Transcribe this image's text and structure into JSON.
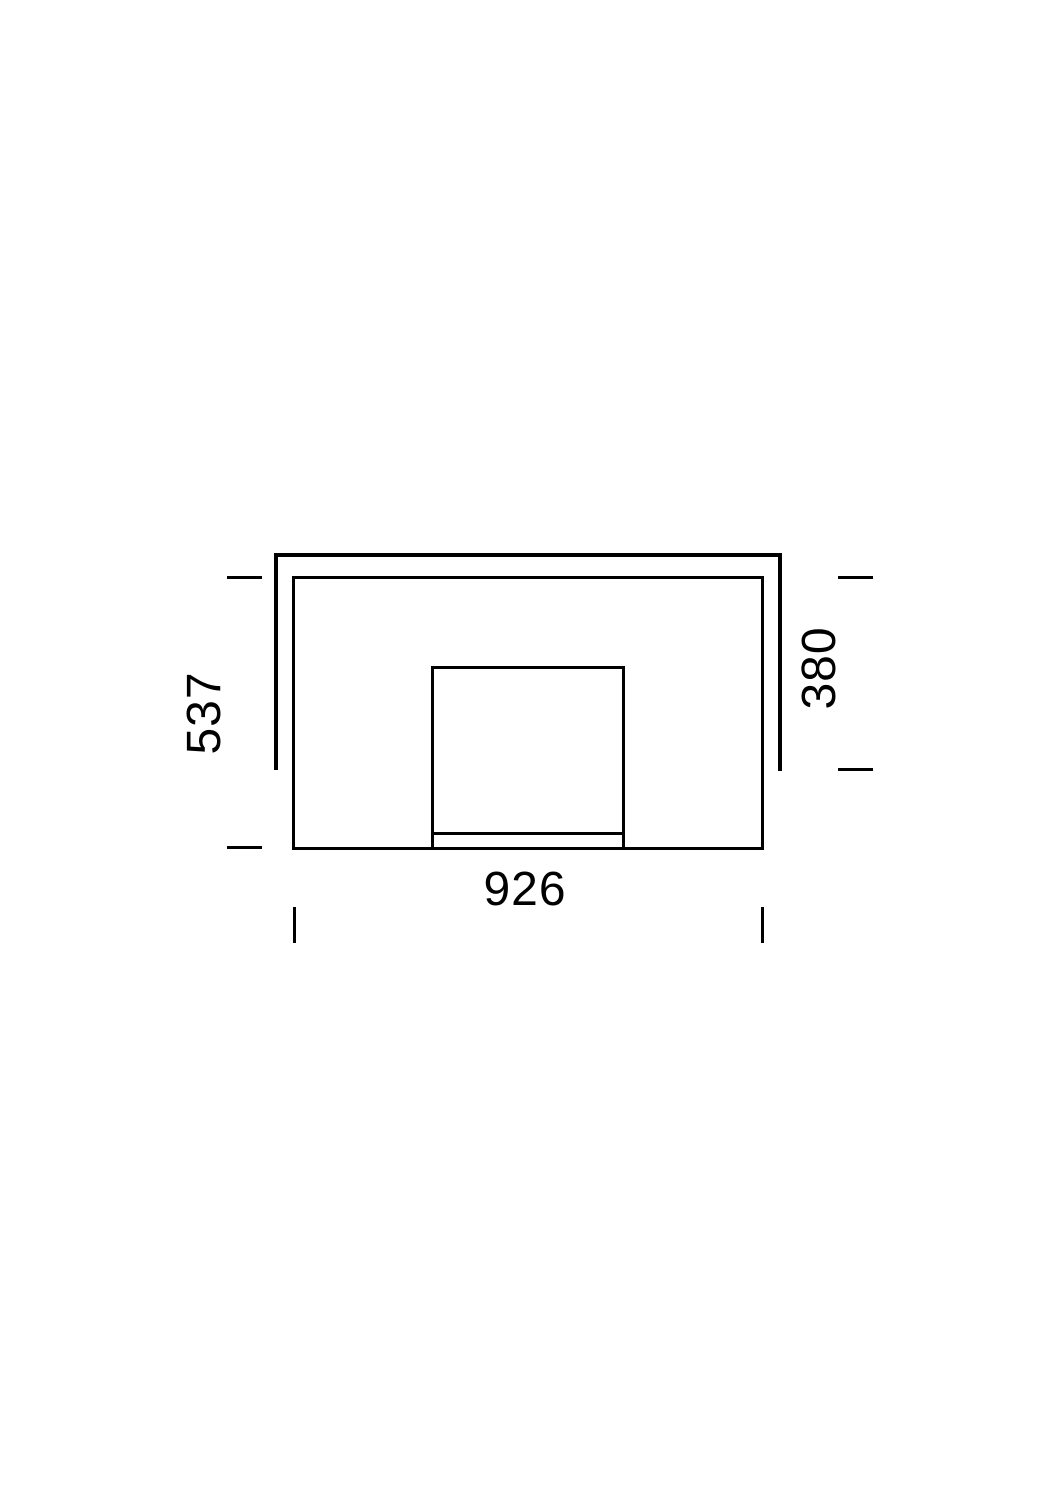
{
  "drawing": {
    "dimensions": {
      "left": "537",
      "right": "380",
      "bottom": "926"
    },
    "colors": {
      "line": "#000000",
      "background": "#ffffff"
    }
  }
}
